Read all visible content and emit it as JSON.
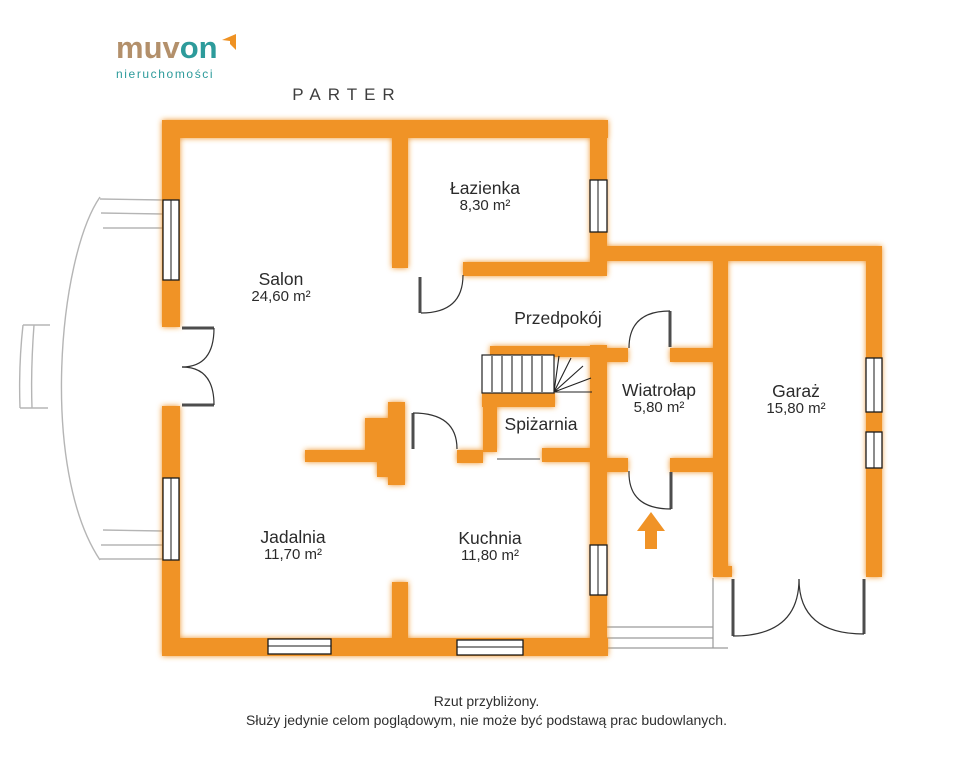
{
  "logo": {
    "brand_part1": "muv",
    "brand_part2": "on",
    "tagline": "nieruchomości"
  },
  "title": "PARTER",
  "rooms": [
    {
      "name": "Salon",
      "area": "24,60 m²"
    },
    {
      "name": "Łazienka",
      "area": "8,30 m²"
    },
    {
      "name": "Przedpokój",
      "area": ""
    },
    {
      "name": "Spiżarnia",
      "area": ""
    },
    {
      "name": "Wiatrołap",
      "area": "5,80 m²"
    },
    {
      "name": "Garaż",
      "area": "15,80 m²"
    },
    {
      "name": "Jadalnia",
      "area": "11,70 m²"
    },
    {
      "name": "Kuchnia",
      "area": "11,80 m²"
    }
  ],
  "disclaimer": {
    "line1": "Rzut przybliżony.",
    "line2": "Służy jedynie celom poglądowym, nie może być podstawą prac budowlanych."
  },
  "icons": {
    "entrance_arrow": "arrow-up-icon",
    "logo_arrow": "bent-arrow-icon"
  },
  "colors": {
    "wall_orange": "#F09327",
    "brand_tan": "#B3906B",
    "brand_teal": "#2D9B9B",
    "door_gray": "#4D4D4D",
    "text_dark": "#2B2B2B"
  }
}
